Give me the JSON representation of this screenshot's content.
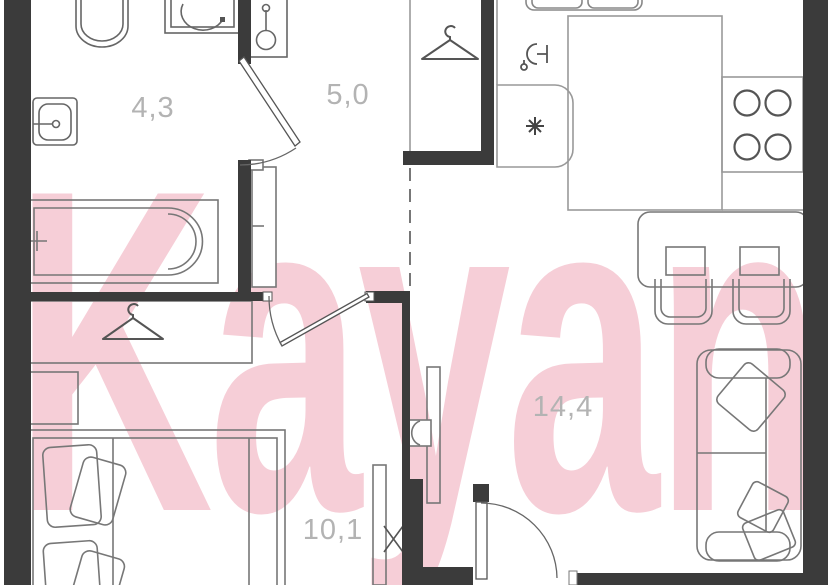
{
  "plan": {
    "watermark": "Kayan",
    "rooms": [
      {
        "name": "bathroom",
        "area_label": "4,3"
      },
      {
        "name": "hallway",
        "area_label": "5,0"
      },
      {
        "name": "kitchen-living-room",
        "area_label": "14,4"
      },
      {
        "name": "bedroom",
        "area_label": "10,1"
      }
    ],
    "colors": {
      "wall": "#3b3b3b",
      "furniture_line": "#7d7d7d",
      "fixture_line": "#555555",
      "counter_line": "#999999",
      "area_label": "#b3b3b3",
      "watermark_pink": "#f6ced7",
      "background": "#ffffff"
    },
    "icons": [
      "toilet-icon",
      "washing-machine-icon",
      "bathtub-icon",
      "washbasin-icon",
      "wall-lamp-icon",
      "clothes-hanger-icon",
      "kitchen-sink-icon",
      "glassware-icon",
      "snowflake-icon",
      "stove-burners-icon",
      "sliding-door-mark-icon"
    ]
  }
}
